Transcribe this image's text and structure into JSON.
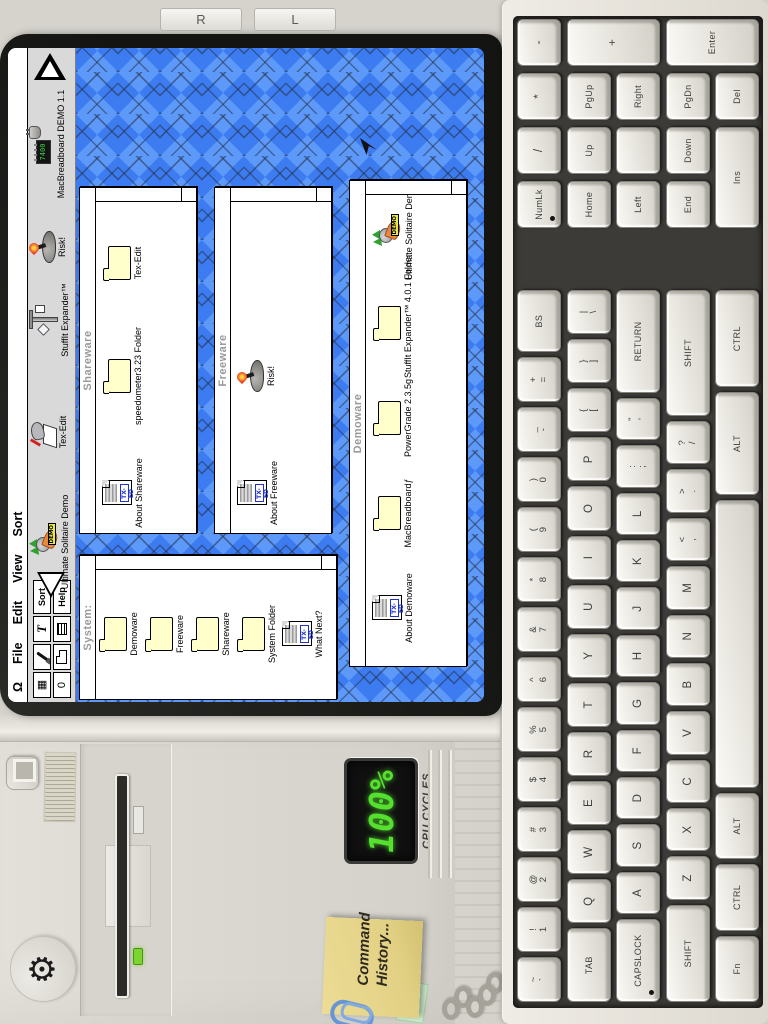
{
  "overlay": {
    "buttons": [
      "R",
      "L"
    ]
  },
  "monitor": {
    "menu": {
      "items": [
        "Ω",
        "File",
        "Edit",
        "View",
        "Sort"
      ]
    },
    "palette": [
      {
        "name": "grid-icon",
        "glyph": "▦"
      },
      {
        "name": "brush-icon",
        "css": "mini-brush"
      },
      {
        "name": "italic-t-icon",
        "glyph": "T",
        "cls": "pal-t"
      },
      {
        "name": "sort-button",
        "label": "Sort"
      },
      {
        "name": "clip-icon",
        "glyph": "0"
      },
      {
        "name": "folder-icon",
        "css": "mini-folder"
      },
      {
        "name": "list-icon",
        "css": "mini-list"
      },
      {
        "name": "help-button",
        "label": "Help"
      }
    ],
    "desktop_icons": [
      {
        "label": "Ultimate Solitaire Demo",
        "icon": "joker"
      },
      {
        "label": "Tex-Edit",
        "icon": "texedit"
      },
      {
        "label": "StuffIt Expander™",
        "icon": "stuffit"
      },
      {
        "label": "Risk!",
        "icon": "risk"
      },
      {
        "label": "MacBreadboard DEMO 1.1",
        "icon": "chip"
      }
    ],
    "windows": [
      {
        "title": "System:",
        "items": [
          {
            "label": "Demoware",
            "icon": "folder"
          },
          {
            "label": "Freeware",
            "icon": "folder"
          },
          {
            "label": "Shareware",
            "icon": "folder"
          },
          {
            "label": "System Folder",
            "icon": "folder"
          },
          {
            "label": "What Next?",
            "icon": "txed"
          }
        ]
      },
      {
        "title": "Shareware",
        "items": [
          {
            "label": "About Shareware",
            "icon": "txed"
          },
          {
            "label": "speedometer3.23 Folder",
            "icon": "folder"
          },
          {
            "label": "Tex-Edit",
            "icon": "folder"
          }
        ]
      },
      {
        "title": "Freeware",
        "items": [
          {
            "label": "About Freeware",
            "icon": "txed"
          },
          {
            "label": "Risk!",
            "icon": "risk"
          }
        ]
      },
      {
        "title": "Demoware",
        "items": [
          {
            "label": "About Demoware",
            "icon": "txed"
          },
          {
            "label": "MacBreadboardƒ",
            "icon": "folder"
          },
          {
            "label": "PowerGrade 2.3.5g",
            "icon": "folder"
          },
          {
            "label": "StuffIt Expander™ 4.0.1 Folder",
            "icon": "folder"
          },
          {
            "label": "Ultimate Solitaire Demo",
            "icon": "joker"
          }
        ]
      }
    ],
    "icon_strings": {
      "txed_tag": "TX-ED",
      "chip_text": "7400",
      "demo_badge": "DEMO"
    }
  },
  "tower": {
    "cpu": {
      "value": "100%",
      "label": "CPU CYCLES"
    },
    "sticky_note": {
      "line1": "Command",
      "line2": "History..."
    },
    "icons": {
      "gear": "⚙"
    }
  },
  "keyboard": {
    "main_rows": [
      [
        {
          "sub": "~",
          "label": "`"
        },
        {
          "sub": "!",
          "label": "1"
        },
        {
          "sub": "@",
          "label": "2"
        },
        {
          "sub": "#",
          "label": "3"
        },
        {
          "sub": "$",
          "label": "4"
        },
        {
          "sub": "%",
          "label": "5"
        },
        {
          "sub": "^",
          "label": "6"
        },
        {
          "sub": "&",
          "label": "7"
        },
        {
          "sub": "*",
          "label": "8"
        },
        {
          "sub": "(",
          "label": "9"
        },
        {
          "sub": ")",
          "label": "0"
        },
        {
          "sub": "_",
          "label": "-"
        },
        {
          "sub": "+",
          "label": "="
        },
        {
          "label": "BS",
          "w": 1.4,
          "small": true
        }
      ],
      [
        {
          "label": "TAB",
          "w": 1.7,
          "small": true
        },
        {
          "label": "Q"
        },
        {
          "label": "W"
        },
        {
          "label": "E"
        },
        {
          "label": "R"
        },
        {
          "label": "T"
        },
        {
          "label": "Y"
        },
        {
          "label": "U"
        },
        {
          "label": "I"
        },
        {
          "label": "O"
        },
        {
          "label": "P"
        },
        {
          "sub": "{",
          "label": "["
        },
        {
          "sub": "}",
          "label": "]"
        },
        {
          "sub": "|",
          "label": "\\"
        }
      ],
      [
        {
          "label": "CAPSLOCK",
          "w": 2.0,
          "small": true,
          "led": true
        },
        {
          "label": "A"
        },
        {
          "label": "S"
        },
        {
          "label": "D"
        },
        {
          "label": "F"
        },
        {
          "label": "G"
        },
        {
          "label": "H"
        },
        {
          "label": "J"
        },
        {
          "label": "K"
        },
        {
          "label": "L"
        },
        {
          "sub": ":",
          "label": ";"
        },
        {
          "sub": "\"",
          "label": "'"
        },
        {
          "label": "RETURN",
          "w": 2.5,
          "small": true
        }
      ],
      [
        {
          "label": "SHIFT",
          "w": 2.3,
          "small": true
        },
        {
          "label": "Z"
        },
        {
          "label": "X"
        },
        {
          "label": "C"
        },
        {
          "label": "V"
        },
        {
          "label": "B"
        },
        {
          "label": "N"
        },
        {
          "label": "M"
        },
        {
          "sub": "<",
          "label": ","
        },
        {
          "sub": ">",
          "label": "."
        },
        {
          "sub": "?",
          "label": "/"
        },
        {
          "label": "SHIFT",
          "w": 3.0,
          "small": true
        }
      ],
      [
        {
          "label": "Fn",
          "w": 1.35,
          "small": true
        },
        {
          "label": "CTRL",
          "w": 1.35,
          "small": true
        },
        {
          "label": "ALT",
          "w": 1.35,
          "small": true
        },
        {
          "label": "",
          "w": 6.0,
          "space": true
        },
        {
          "label": "ALT",
          "w": 2.1,
          "small": true
        },
        {
          "label": "CTRL",
          "w": 2.0,
          "small": true
        }
      ]
    ],
    "numpad": [
      {
        "label": "NumLk",
        "r": 1,
        "c": 1,
        "small": true,
        "led": true
      },
      {
        "label": "/",
        "r": 1,
        "c": 2
      },
      {
        "label": "*",
        "r": 1,
        "c": 3
      },
      {
        "label": "-",
        "r": 1,
        "c": 4
      },
      {
        "label": "Home",
        "r": 2,
        "c": 1,
        "small": true
      },
      {
        "label": "Up",
        "r": 2,
        "c": 2,
        "small": true
      },
      {
        "label": "PgUp",
        "r": 2,
        "c": 3,
        "small": true
      },
      {
        "label": "+",
        "r": 2,
        "c": 4,
        "rs": 2
      },
      {
        "label": "Left",
        "r": 3,
        "c": 1,
        "small": true
      },
      {
        "label": "",
        "r": 3,
        "c": 2
      },
      {
        "label": "Right",
        "r": 3,
        "c": 3,
        "small": true
      },
      {
        "label": "End",
        "r": 4,
        "c": 1,
        "small": true
      },
      {
        "label": "Down",
        "r": 4,
        "c": 2,
        "small": true
      },
      {
        "label": "PgDn",
        "r": 4,
        "c": 3,
        "small": true
      },
      {
        "label": "Enter",
        "r": 4,
        "c": 4,
        "rs": 2,
        "small": true
      },
      {
        "label": "Ins",
        "r": 5,
        "c": 1,
        "cs": 2,
        "small": true
      },
      {
        "label": "Del",
        "r": 5,
        "c": 3,
        "small": true
      }
    ]
  },
  "colors": {
    "desktop_blue": "#4285f4",
    "led_green": "#55e030",
    "sticky_yellow": "#e2d184"
  }
}
